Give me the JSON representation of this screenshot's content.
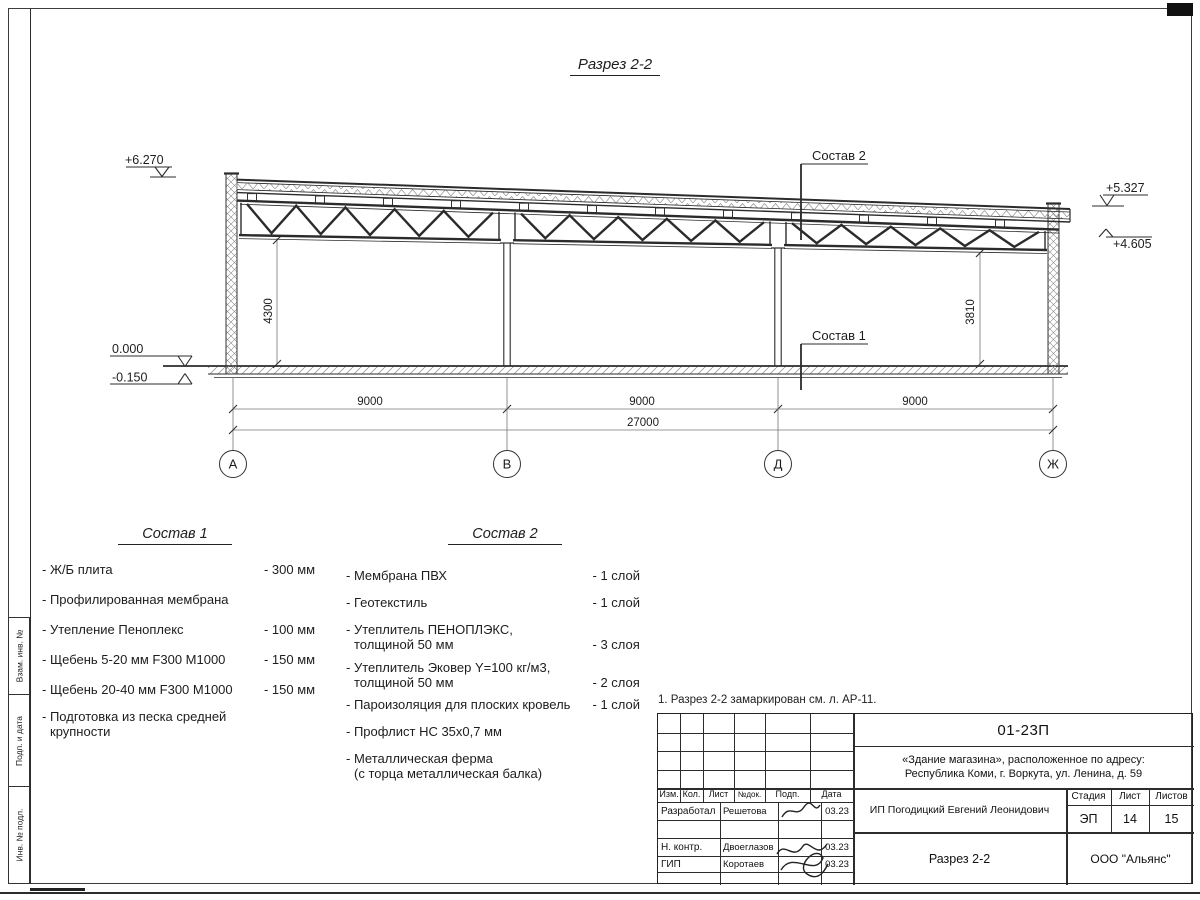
{
  "sheet": {
    "title": "Разрез 2-2",
    "note": "1. Разрез 2-2 замаркирован см. л. АР-11."
  },
  "drawing": {
    "axes": [
      "А",
      "В",
      "Д",
      "Ж"
    ],
    "dims": {
      "bay1": "9000",
      "bay2": "9000",
      "bay3": "9000",
      "total": "27000",
      "left_height": "4300",
      "right_height": "3810"
    },
    "elevations": {
      "parapet_left": "+6.270",
      "floor": "0.000",
      "ground": "-0.150",
      "parapet_right": "+5.327",
      "truss_right": "+4.605"
    },
    "leaders": {
      "sostav1": "Состав 1",
      "sostav2": "Состав 2"
    }
  },
  "sostav1": {
    "title": "Состав 1",
    "items": [
      {
        "name": "- Ж/Б плита",
        "value": "- 300 мм"
      },
      {
        "name": "- Профилированная мембрана",
        "value": ""
      },
      {
        "name": "- Утепление Пеноплекс",
        "value": "- 100 мм"
      },
      {
        "name": "-  Щебень 5-20 мм F300 М1000",
        "value": "- 150 мм"
      },
      {
        "name": "-  Щебень 20-40 мм F300 М1000",
        "value": "- 150 мм"
      },
      {
        "name": "- Подготовка из песка средней\nкрупности",
        "value": ""
      }
    ]
  },
  "sostav2": {
    "title": "Состав 2",
    "items": [
      {
        "name": "- Мембрана ПВХ",
        "value": "- 1 слой"
      },
      {
        "name": "- Геотекстиль",
        "value": "- 1 слой"
      },
      {
        "name": "- Утеплитель ПЕНОПЛЭКС,\nтолщиной 50 мм",
        "value": "- 3 слоя"
      },
      {
        "name": "- Утеплитель Эковер Y=100 кг/м3,\nтолщиной 50 мм",
        "value": "- 2 слоя"
      },
      {
        "name": "- Пароизоляция для плоских кровель",
        "value": "- 1 слой"
      },
      {
        "name": "- Профлист НС 35х0,7 мм",
        "value": ""
      },
      {
        "name": "- Металлическая ферма\n(с торца металлическая балка)",
        "value": ""
      }
    ]
  },
  "titleblock": {
    "code": "01-23П",
    "object": "«Здание магазина», расположенное по адресу:\nРеспублика Коми, г. Воркута, ул. Ленина, д. 59",
    "columns": [
      "Изм.",
      "Кол.",
      "Лист",
      "№док.",
      "Подп.",
      "Дата"
    ],
    "rows": [
      {
        "role": "Разработал",
        "name": "Решетова",
        "date": "03.23"
      },
      {
        "role": "Н. контр.",
        "name": "Двоеглазов",
        "date": "03.23"
      },
      {
        "role": "ГИП",
        "name": "Коротаев",
        "date": "03.23"
      }
    ],
    "client": "ИП Погодицкий Евгений Леонидович",
    "stage_label": "Стадия",
    "sheet_label": "Лист",
    "sheets_label": "Листов",
    "stage": "ЭП",
    "sheet_no": "14",
    "sheets_total": "15",
    "doc_title": "Разрез 2-2",
    "company": "ООО \"Альянс\""
  },
  "side_stamp": {
    "labels": [
      "Взам. инв. №",
      "Подп. и дата",
      "Инв. № подл."
    ]
  }
}
